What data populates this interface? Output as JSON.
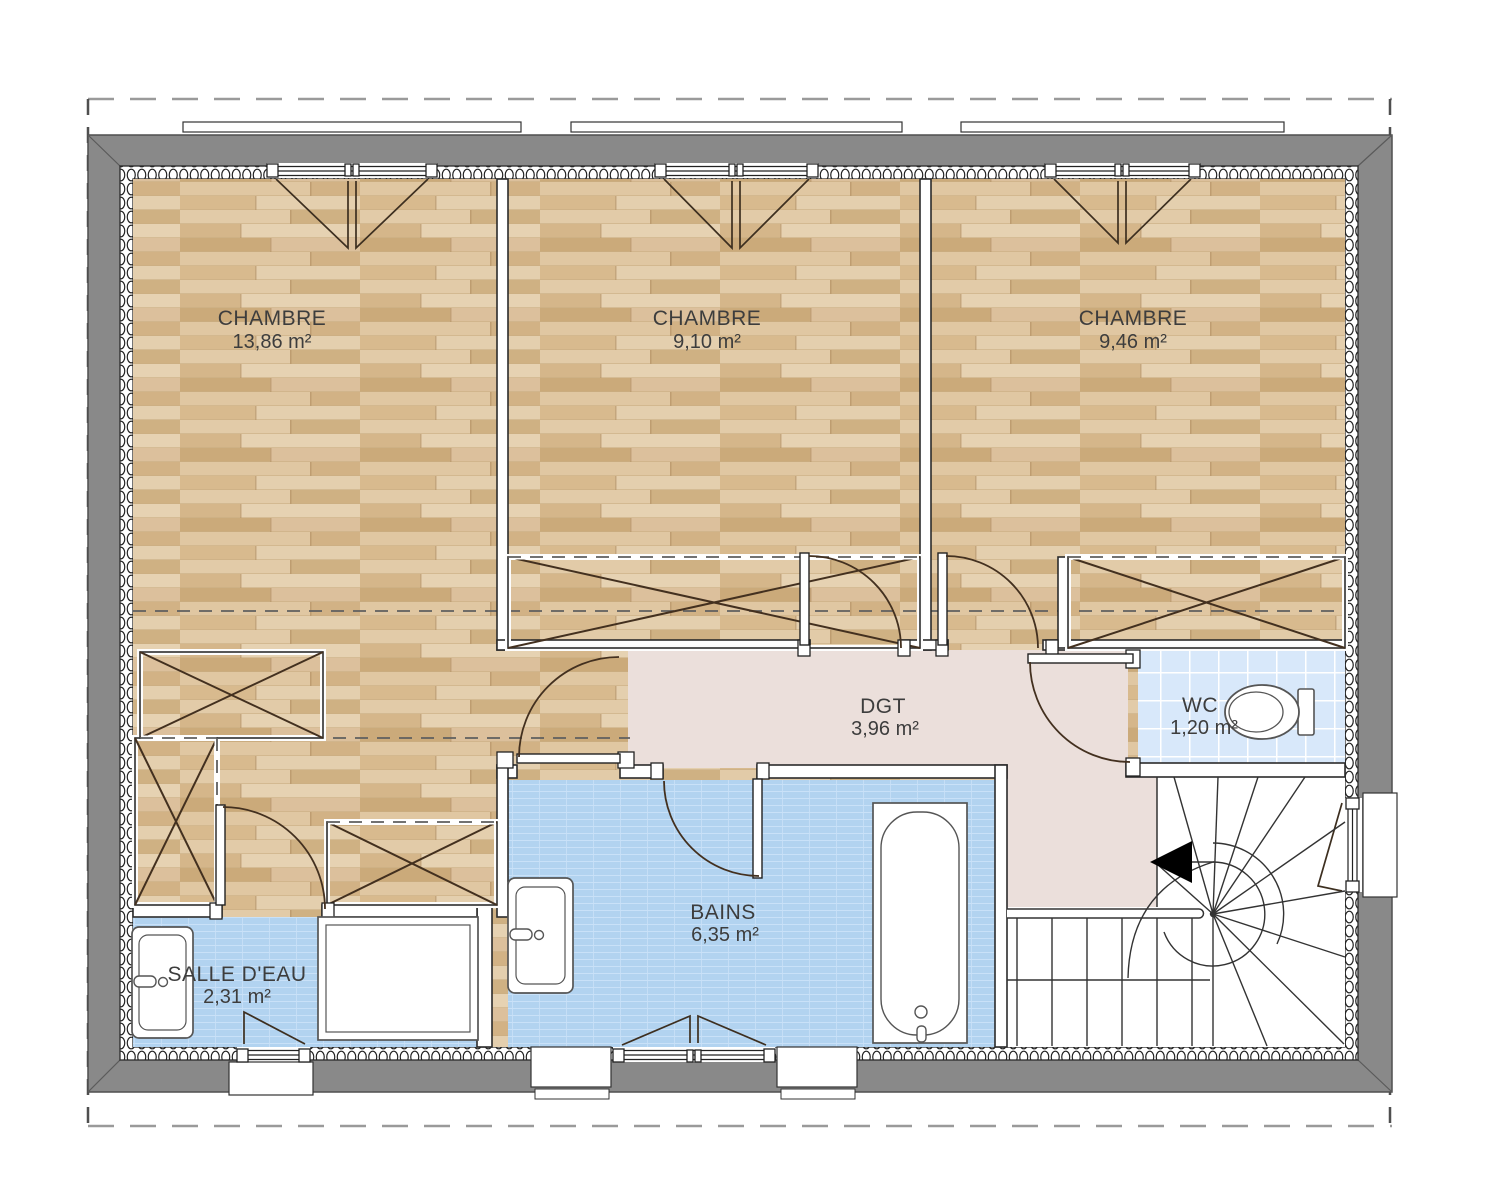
{
  "plan": {
    "type": "floor-plan",
    "floor": "étage (upper floor)",
    "rooms": {
      "chambre1": {
        "name": "CHAMBRE",
        "area": "13,86 m²"
      },
      "chambre2": {
        "name": "CHAMBRE",
        "area": "9,10 m²"
      },
      "chambre3": {
        "name": "CHAMBRE",
        "area": "9,46 m²"
      },
      "dgt": {
        "name": "DGT",
        "area": "3,96 m²"
      },
      "wc": {
        "name": "WC",
        "area": "1,20 m²"
      },
      "bains": {
        "name": "BAINS",
        "area": "6,35 m²"
      },
      "salle_deau": {
        "name": "SALLE D'EAU",
        "area": "2,31 m²"
      }
    },
    "fixtures": [
      "toilet",
      "bathtub",
      "shower-tray",
      "sink-salle-deau",
      "sink-bains",
      "staircase-winder"
    ],
    "colors": {
      "wall_gray": "#898989",
      "dgt_floor": "#ebdfdb",
      "wood_base": "#d8bc93",
      "tile_blue": "#b2d3f0",
      "wc_tile": "#d8e8fa",
      "line_dark": "#2b2b2b"
    }
  }
}
